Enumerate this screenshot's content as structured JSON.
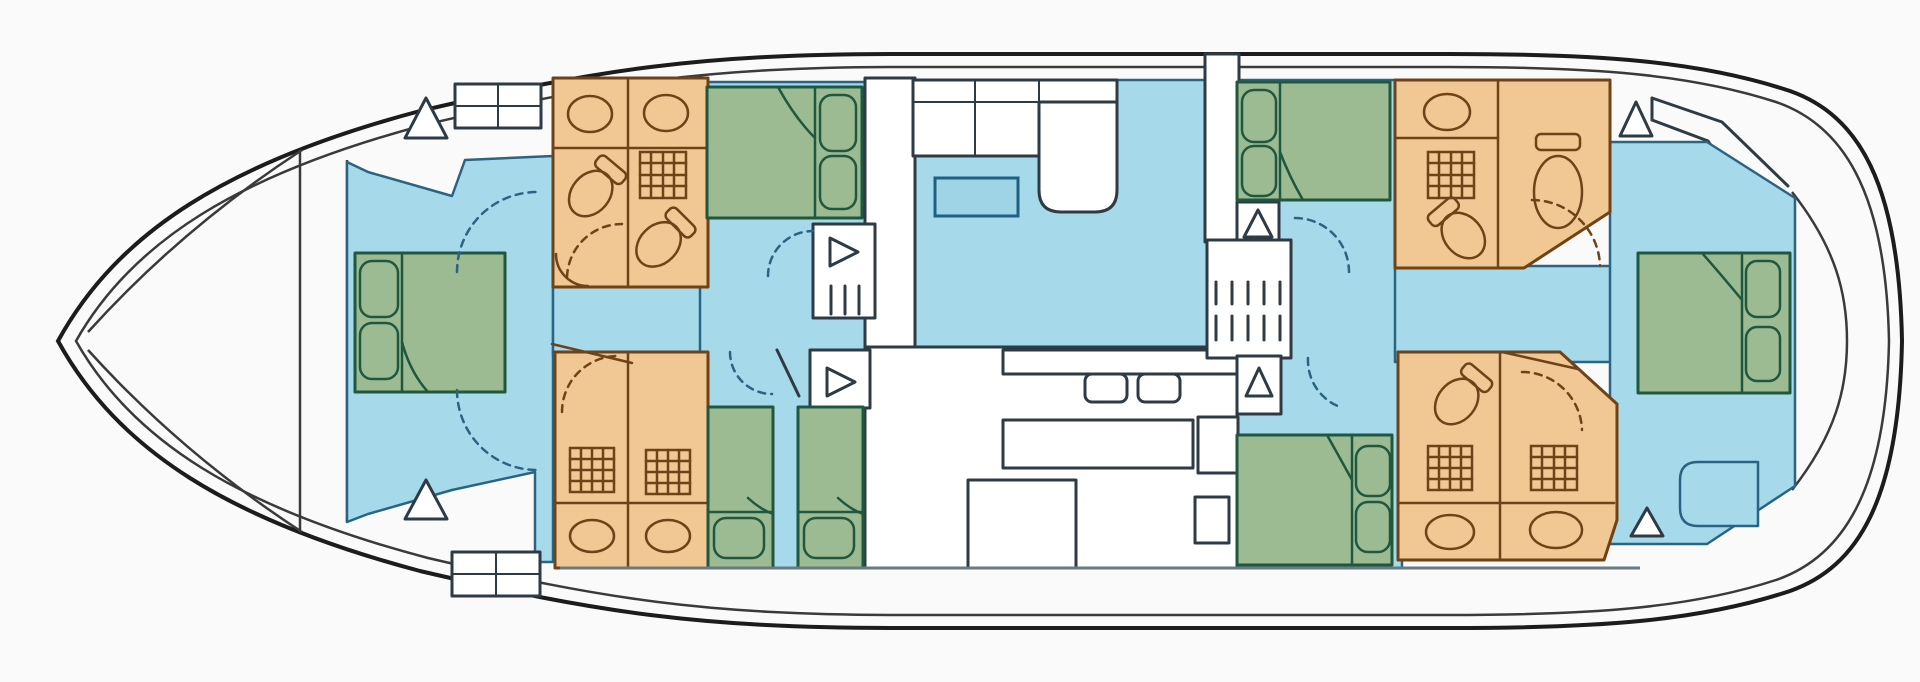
{
  "diagram": {
    "type": "boat-deck-floor-plan",
    "orientation": "bow-left-stern-right",
    "text_labels": []
  },
  "colors": {
    "bg": "#fafafa",
    "hull": "#1c1c1c",
    "hull_inner": "#3a3a3a",
    "wall": "#2f3b44",
    "floor": "#a6d9ea",
    "floor_line": "#2b6483",
    "white": "#ffffff",
    "bath_fill": "#f1c794",
    "bath_line": "#6f4317",
    "bed_fill": "#9cbb92",
    "bed_line": "#20573f",
    "table_fill": "#9fd3e6",
    "table_line": "#1f5f82"
  },
  "inventory": {
    "cabins": [
      {
        "id": "bow-cabin",
        "bed": "double",
        "pillows": 2
      },
      {
        "id": "forward-upper-cabin",
        "bed": "double",
        "pillows": 2
      },
      {
        "id": "forward-lower-cabin",
        "bed": "two-singles",
        "pillows": 2
      },
      {
        "id": "aft-upper-cabin",
        "bed": "double",
        "pillows": 2
      },
      {
        "id": "aft-lower-cabin",
        "bed": "double",
        "pillows": 2
      },
      {
        "id": "stern-cabin",
        "bed": "double",
        "pillows": 2
      }
    ],
    "bathrooms": [
      {
        "id": "forward-upper-bathroom",
        "fixtures": [
          "sink",
          "sink",
          "shower",
          "toilet",
          "toilet"
        ]
      },
      {
        "id": "forward-lower-bathroom",
        "fixtures": [
          "shower",
          "shower",
          "sink",
          "sink"
        ]
      },
      {
        "id": "aft-upper-bathroom",
        "fixtures": [
          "sink",
          "shower",
          "toilet",
          "toilet"
        ]
      },
      {
        "id": "aft-lower-bathroom",
        "fixtures": [
          "toilet",
          "shower",
          "shower",
          "sink",
          "sink"
        ]
      }
    ],
    "shared_areas": [
      "saloon-settee",
      "dinette-table",
      "galley",
      "midship-staircase",
      "companionway-steps",
      "stern-bench"
    ],
    "deck_hatch_triangles": 8,
    "door_swings_dashed": 9
  }
}
